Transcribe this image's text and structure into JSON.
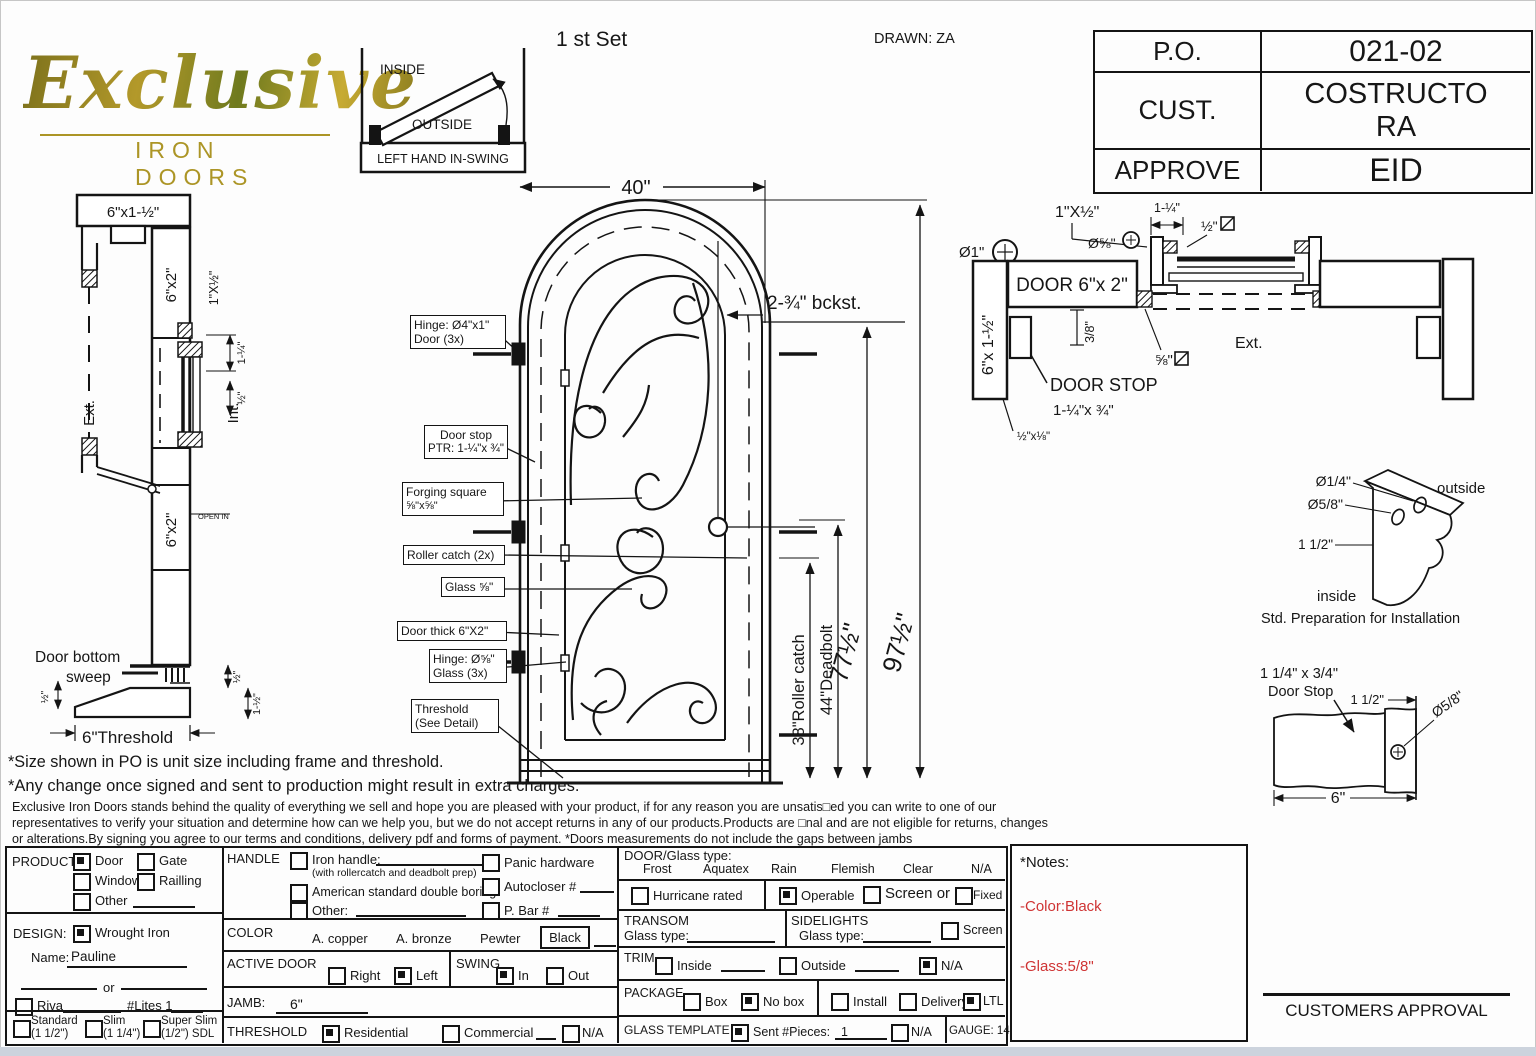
{
  "page": {
    "set_label": "1 st Set",
    "drawn_by": "DRAWN: ZA"
  },
  "logo": {
    "word": "Exclusive",
    "subtitle": "IRON DOORS"
  },
  "swing_diagram": {
    "inside": "INSIDE",
    "outside": "OUTSIDE",
    "caption": "LEFT HAND IN-SWING"
  },
  "po_table": {
    "po_label": "P.O.",
    "po_value": "021-02",
    "cust_label": "CUST.",
    "cust_value": "COSTRUCTORA",
    "approve_label": "APPROVE",
    "approve_value": "EID"
  },
  "side_section": {
    "header_size": "6\"x1-½\"",
    "jamb_size": "6\"x2\"",
    "stop_profile": "1\"X½\"",
    "dim_1q": "1-¼\"",
    "dim_half": "½\"",
    "ext_label": "Ext.",
    "int_label": "Int.",
    "open_in": "OPEN IN",
    "lower_jamb_size": "6\"x2\"",
    "sweep_line1": "Door bottom",
    "sweep_line2": "sweep",
    "dim_half_left": "½\"",
    "dim_half_right": "½\"",
    "dim_1half_right": "1-½\"",
    "threshold_label": "6\"Threshold"
  },
  "elevation": {
    "width_dim": "40\"",
    "backset": "2-¾\"  bckst.",
    "height_total": "97½\"",
    "height_door": "77½\"",
    "roller_dim": "38\"Roller catch",
    "deadbolt_dim": "44\"Deadbolt",
    "callout_hinge_door_1": "Hinge: Ø4\"x1\"",
    "callout_hinge_door_2": "Door (3x)",
    "callout_door_stop_1": "Door stop",
    "callout_door_stop_2": "PTR: 1-¼\"x ¾\"",
    "callout_forging_1": "Forging square",
    "callout_forging_2": "⅝\"x⅝\"",
    "callout_roller": "Roller catch  (2x)",
    "callout_glass": "Glass ⅝\"",
    "callout_door_thick": "Door thick 6\"X2\"",
    "callout_hinge_glass_1": "Hinge: Ø⅝\"",
    "callout_hinge_glass_2": "Glass (3x)",
    "callout_threshold_1": "Threshold",
    "callout_threshold_2": "(See Detail)"
  },
  "head_section": {
    "stop_profile": "1\"X½\"",
    "dia_58": "Ø⅝\"",
    "dia_1": "Ø1\"",
    "door_label": "DOOR 6\"x 2\"",
    "jamb_label": "6\"x 1-½\"",
    "dim_38": "3/8\"",
    "dim_1q": "1-¼\"",
    "dim_half": "½\"",
    "dim_58": "⅝\"",
    "ext_label": "Ext.",
    "door_stop_label": "DOOR STOP",
    "door_stop_size": "1-¼\"x ¾\"",
    "strip_size": "½\"x⅛\""
  },
  "std_prep": {
    "dia_quarter": "Ø1/4\"",
    "dia_58": "Ø5/8\"",
    "dim_1half": "1 1/2\"",
    "outside": "outside",
    "inside": "inside",
    "caption": "Std. Preparation for Installation"
  },
  "stop_detail": {
    "title_1": "1 1/4\" x 3/4\"",
    "title_2": "Door Stop",
    "dim_1half": "1 1/2\"",
    "dia_58": "Ø5/8\"",
    "dim_6": "6\""
  },
  "disclaimer": {
    "line1": "*Size shown in PO is unit size including frame and threshold.",
    "line2": "*Any change once signed and sent to production might result in extra charges.",
    "line3": "Exclusive Iron Doors stands behind the quality of everything we sell and hope you are pleased with your product, if for any reason you are unsatis□ed you can write to one of our",
    "line4": "representatives to verify your situation and determine how can we help you, but we do not accept returns in any of our products.Products are □nal and are not eligible for returns, changes",
    "line5": "or alterations.By signing you agree to our terms and conditions, delivery pdf and forms of payment. *Doors measurements do not include the gaps between jambs"
  },
  "form": {
    "product": {
      "label": "PRODUCT:",
      "door": "Door",
      "gate": "Gate",
      "window": "Window",
      "railing": "Railling",
      "other": "Other"
    },
    "design": {
      "label": "DESIGN:",
      "wrought_iron": "Wrought Iron",
      "name_label": "Name:",
      "name_value": "Pauline",
      "or_label": "or",
      "riva": "Riva",
      "lites": "#Lites 1",
      "standard": "Standard",
      "standard_size": "(1 1/2\")",
      "slim": "Slim",
      "slim_size": "(1 1/4\")",
      "super_slim": "Super Slim",
      "super_slim_size": "(1/2\") SDL"
    },
    "handle": {
      "label": "HANDLE",
      "iron_handle": "Iron handle:",
      "iron_handle_note": "(with rollercatch and deadbolt prep)",
      "american": "American standard double boring",
      "other": "Other:",
      "panic": "Panic hardware",
      "autocloser": "Autocloser #",
      "p_bar": "P. Bar #"
    },
    "color": {
      "label": "COLOR",
      "copper": "A. copper",
      "bronze": "A. bronze",
      "pewter": "Pewter",
      "black": "Black"
    },
    "active_door": {
      "label": "ACTIVE DOOR",
      "right": "Right",
      "left": "Left"
    },
    "swing": {
      "label": "SWING",
      "in": "In",
      "out": "Out"
    },
    "jamb": {
      "label": "JAMB:",
      "value": "6\""
    },
    "threshold": {
      "label": "THRESHOLD",
      "residential": "Residential",
      "commercial": "Commercial",
      "na": "N/A"
    },
    "glass": {
      "label": "DOOR/Glass type:",
      "frost": "Frost",
      "aquatex": "Aquatex",
      "rain": "Rain",
      "flemish": "Flemish",
      "clear": "Clear",
      "na": "N/A"
    },
    "hurricane": {
      "label": "Hurricane rated"
    },
    "operable": {
      "operable": "Operable",
      "screen_or": "Screen or",
      "fixed": "Fixed"
    },
    "transom": {
      "label": "TRANSOM",
      "glass_type": "Glass type:"
    },
    "sidelights": {
      "label": "SIDELIGHTS",
      "glass_type": "Glass type:",
      "screen": "Screen"
    },
    "trim": {
      "label": "TRIM",
      "inside": "Inside",
      "outside": "Outside",
      "na": "N/A"
    },
    "package": {
      "label": "PACKAGE",
      "box": "Box",
      "no_box": "No box",
      "install": "Install",
      "delivery": "Delivery",
      "ltl": "LTL"
    },
    "glass_template": {
      "label": "GLASS TEMPLATE",
      "sent": "Sent #Pieces:",
      "pieces": "1",
      "na": "N/A"
    },
    "gauge": "GAUGE: 14"
  },
  "notes": {
    "title": "*Notes:",
    "color_note": "-Color:Black",
    "glass_note": "-Glass:5/8\"",
    "note_color": "#cf3434"
  },
  "approval": {
    "label": "CUSTOMERS APPROVAL"
  }
}
